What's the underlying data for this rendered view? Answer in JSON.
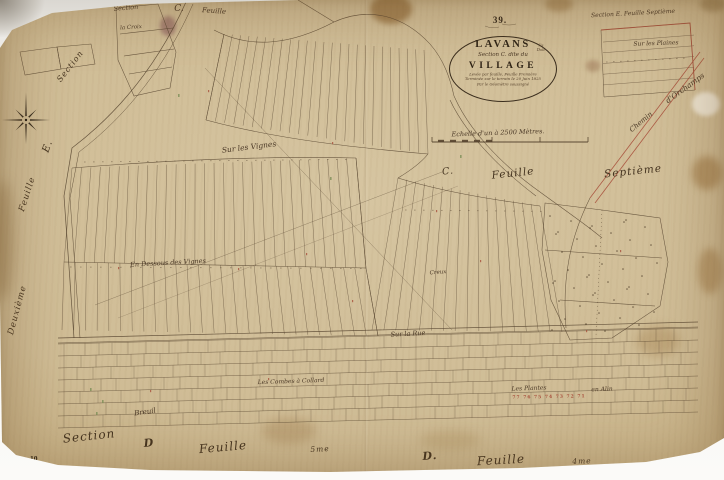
{
  "page": {
    "sheet_number": "39.",
    "plate_number": "10"
  },
  "cartouche": {
    "commune": "LAVANS",
    "commune_note": "lès Dole",
    "section_line": "Section C. dite du",
    "place_name": "VILLAGE",
    "note_lines": [
      "Levée par feuille, Feuille Première",
      "Terminée sur le terrain le 20 Juin 1825",
      "Par le Géomètre soussigné"
    ],
    "scale_label": "Echelle d'un à 2500 Mètres."
  },
  "labels": [
    {
      "name": "neighbor-sheet-top-section",
      "text": "Section",
      "x": 126,
      "y": 8,
      "r": -5,
      "s": 6.5
    },
    {
      "name": "neighbor-sheet-top-c",
      "text": "C.",
      "x": 179,
      "y": 8,
      "r": 0,
      "s": 9
    },
    {
      "name": "neighbor-sheet-top-feuille",
      "text": "Feuille",
      "x": 214,
      "y": 11,
      "r": 4,
      "s": 7
    },
    {
      "name": "neighbor-sheet-top-right",
      "text": "Section E. Feuille Septième",
      "x": 633,
      "y": 13,
      "r": -3,
      "s": 6
    },
    {
      "name": "placename-sur-les-plaines",
      "text": "Sur les Plaines",
      "x": 656,
      "y": 43,
      "r": -2,
      "s": 6
    },
    {
      "name": "road-label-chemin",
      "text": "Chemin",
      "x": 641,
      "y": 122,
      "r": -40,
      "s": 7
    },
    {
      "name": "road-label-orchamps",
      "text": "d'Orchamps",
      "x": 685,
      "y": 88,
      "r": -36,
      "s": 7.5
    },
    {
      "name": "neighbor-sheet-left-section",
      "text": "Section",
      "x": 70,
      "y": 66,
      "r": -52,
      "s": 8,
      "cls": "lg"
    },
    {
      "name": "neighbor-sheet-left-e",
      "text": "E.",
      "x": 47,
      "y": 146,
      "r": -70,
      "s": 10,
      "cls": "lg"
    },
    {
      "name": "neighbor-sheet-left-feuille",
      "text": "Feuille",
      "x": 27,
      "y": 194,
      "r": -72,
      "s": 8.5,
      "cls": "lg"
    },
    {
      "name": "neighbor-sheet-left-deuxieme",
      "text": "Deuxième",
      "x": 17,
      "y": 310,
      "r": -75,
      "s": 8.5,
      "cls": "lg"
    },
    {
      "name": "placename-la-croix",
      "text": "la Croix",
      "x": 131,
      "y": 27,
      "r": -4,
      "s": 5.5
    },
    {
      "name": "neighbor-sheet-mid-c",
      "text": "C.",
      "x": 448,
      "y": 171,
      "r": -6,
      "s": 9.5,
      "cls": "lg"
    },
    {
      "name": "neighbor-sheet-mid-feuille",
      "text": "Feuille",
      "x": 513,
      "y": 173,
      "r": -6,
      "s": 10.5,
      "cls": "lg"
    },
    {
      "name": "neighbor-sheet-mid-septieme",
      "text": "Septième",
      "x": 633,
      "y": 171,
      "r": -6,
      "s": 10.5,
      "cls": "lg"
    },
    {
      "name": "placename-sur-les-vignes",
      "text": "Sur les Vignes",
      "x": 249,
      "y": 147,
      "r": -7,
      "s": 7.5
    },
    {
      "name": "placename-en-dessous-des-vignes",
      "text": "En Dessous des Vignes",
      "x": 168,
      "y": 263,
      "r": -3,
      "s": 6.5
    },
    {
      "name": "placename-creux",
      "text": "Creux",
      "x": 438,
      "y": 272,
      "r": -4,
      "s": 5.5
    },
    {
      "name": "placename-sur-la-rue",
      "text": "Sur la Rue",
      "x": 408,
      "y": 334,
      "r": -3,
      "s": 6.5
    },
    {
      "name": "placename-les-combes-a-collard",
      "text": "Les Combes à Collard",
      "x": 291,
      "y": 381,
      "r": -2,
      "s": 6
    },
    {
      "name": "placename-les-plantes",
      "text": "Les Plantes",
      "x": 529,
      "y": 388,
      "r": -2,
      "s": 6
    },
    {
      "name": "placename-en-alin",
      "text": "en Alin",
      "x": 602,
      "y": 389,
      "r": -2,
      "s": 6
    },
    {
      "name": "parcel-numbers-red",
      "text": "77 76 75 74 73 72 71",
      "x": 549,
      "y": 397,
      "r": -1,
      "s": 4.5,
      "cls": "red"
    },
    {
      "name": "placename-breuil",
      "text": "Breuil",
      "x": 145,
      "y": 412,
      "r": -8,
      "s": 7
    },
    {
      "name": "neighbor-sheet-bottom-left-section",
      "text": "Section",
      "x": 89,
      "y": 436,
      "r": -6,
      "s": 12,
      "cls": "lg"
    },
    {
      "name": "neighbor-sheet-bottom-left-d",
      "text": "D",
      "x": 149,
      "y": 443,
      "r": -5,
      "s": 11,
      "cls": "lg bold"
    },
    {
      "name": "neighbor-sheet-bottom-left-feuille",
      "text": "Feuille",
      "x": 223,
      "y": 447,
      "r": -5,
      "s": 12,
      "cls": "lg"
    },
    {
      "name": "neighbor-sheet-bottom-left-5me",
      "text": "5me",
      "x": 320,
      "y": 449,
      "r": -3,
      "s": 7.5,
      "cls": "lg"
    },
    {
      "name": "neighbor-sheet-bottom-right-d",
      "text": "D.",
      "x": 430,
      "y": 456,
      "r": -4,
      "s": 11,
      "cls": "lg bold"
    },
    {
      "name": "neighbor-sheet-bottom-right-feuille",
      "text": "Feuille",
      "x": 501,
      "y": 460,
      "r": -3,
      "s": 12,
      "cls": "lg"
    },
    {
      "name": "neighbor-sheet-bottom-right-4me",
      "text": "4me",
      "x": 582,
      "y": 461,
      "r": -2,
      "s": 7.5,
      "cls": "lg"
    }
  ]
}
